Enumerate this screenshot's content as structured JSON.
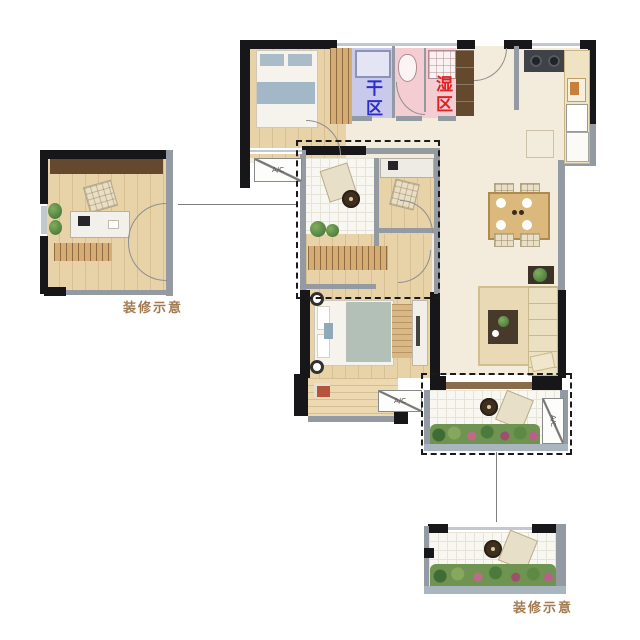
{
  "plan": {
    "zone_labels": {
      "dry": "干区",
      "wet": "湿区"
    },
    "ac_label": "A/C",
    "details": {
      "left_caption": "装修示意",
      "bottom_caption": "装修示意"
    },
    "colors": {
      "dry_zone_fill": "#c9c9ec",
      "dry_zone_text": "#2d2dcc",
      "wet_zone_fill": "#f4cdd3",
      "wet_zone_text": "#dd2323",
      "caption_text": "#a3794f",
      "wall_dark": "#17171a",
      "wall_gray": "#949aa1",
      "floor_cream": "#f3ecdc",
      "floor_wood": "#e8d2a8",
      "balcony_trim": "#a9b6bf",
      "dashed_outline": "#1b1b1b"
    }
  }
}
